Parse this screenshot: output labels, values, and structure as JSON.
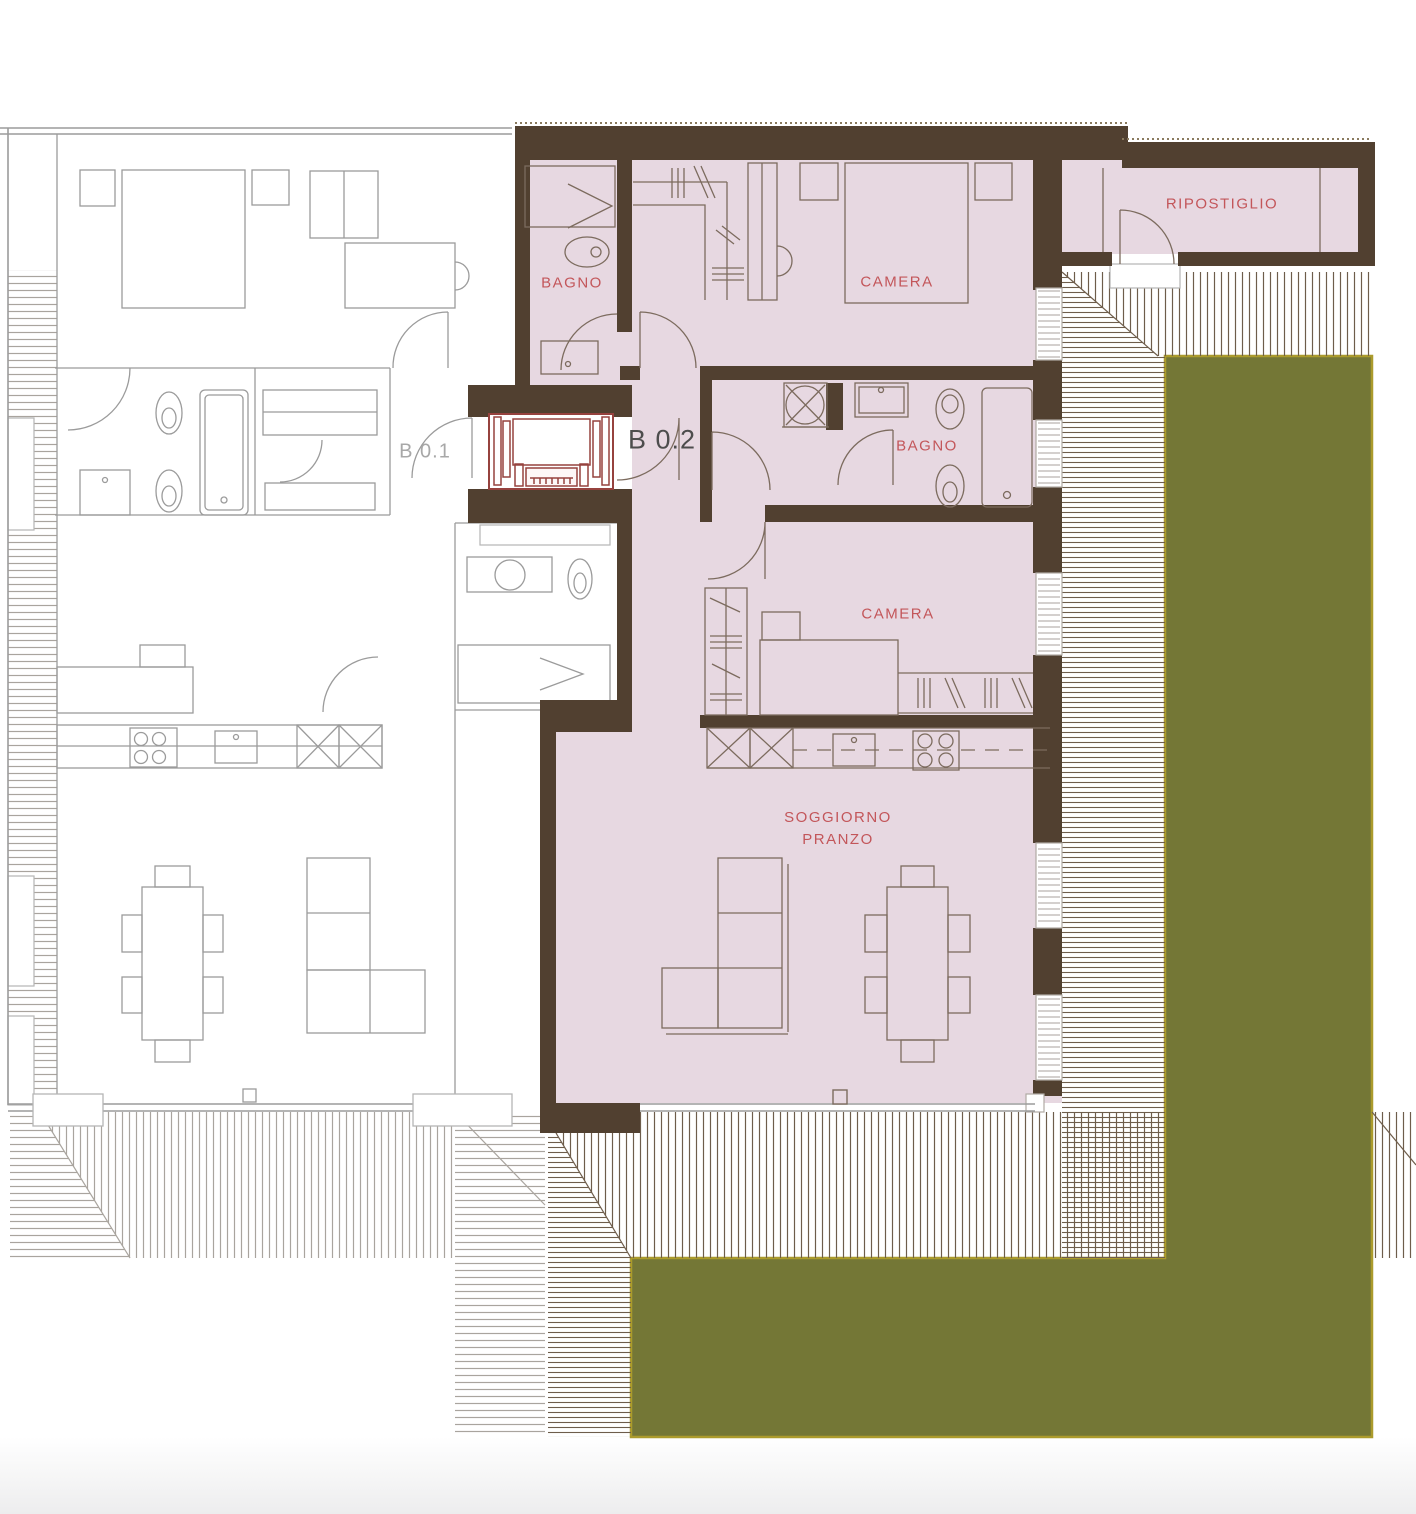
{
  "plan": {
    "unit_label": "B 0.2",
    "neighbor_label": "B 0.1",
    "rooms": {
      "bagno1": "BAGNO",
      "camera1": "CAMERA",
      "bagno2": "BAGNO",
      "camera2": "CAMERA",
      "soggiorno_line1": "SOGGIORNO",
      "soggiorno_line2": "PRANZO",
      "ripostiglio": "RIPOSTIGLIO"
    },
    "colors": {
      "wall_brown": "#514030",
      "room_pink": "#e7d8e1",
      "elevator_red": "#96423e",
      "label_red": "#c3565a",
      "unit_label_dark": "#4d4d4d",
      "neighbor_gray": "#9b9b9b",
      "garden_green": "#747736",
      "garden_border": "#ab9b2c"
    }
  }
}
